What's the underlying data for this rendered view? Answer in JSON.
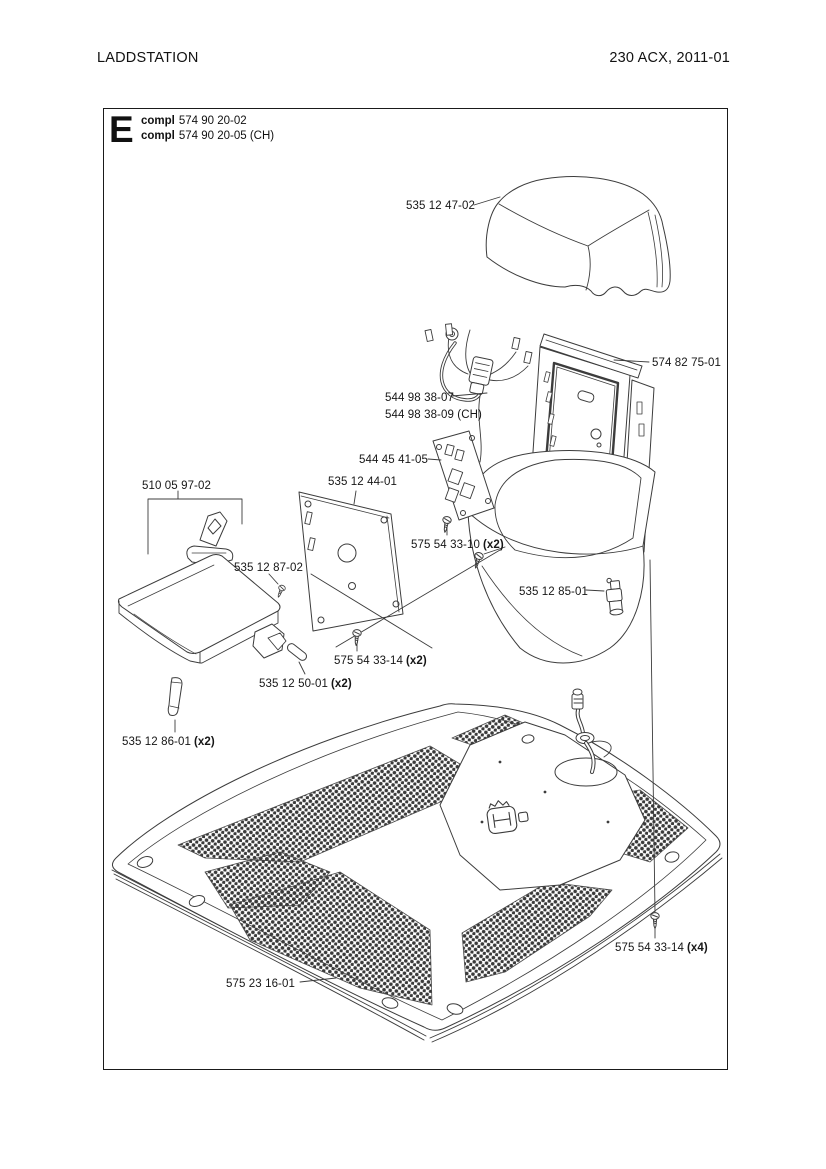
{
  "header": {
    "doc_title": "LADDSTATION",
    "model_revision": "230 ACX, 2011-01"
  },
  "diagram": {
    "section_letter": "E",
    "assemblies": [
      {
        "prefix": "compl",
        "number": "574 90 20-02"
      },
      {
        "prefix": "compl",
        "number": "574 90 20-05 (CH)"
      }
    ],
    "part_labels": [
      {
        "part": "top-cover",
        "text": "535 12 47-02",
        "qty": ""
      },
      {
        "part": "rear-frame",
        "text": "574 82 75-01",
        "qty": ""
      },
      {
        "part": "wiring-harness",
        "text": "544 98 38-07",
        "qty": ""
      },
      {
        "part": "wiring-harness-ch",
        "text": "544 98 38-09 (CH)",
        "qty": ""
      },
      {
        "part": "circuit-board",
        "text": "544 45 41-05",
        "qty": ""
      },
      {
        "part": "mounting-plate",
        "text": "535 12 44-01",
        "qty": ""
      },
      {
        "part": "hinge-kit",
        "text": "510 05 97-02",
        "qty": ""
      },
      {
        "part": "screw-33-10",
        "text": "575 54 33-10",
        "qty": "(x2)"
      },
      {
        "part": "screw-87-02",
        "text": "535 12 87-02",
        "qty": ""
      },
      {
        "part": "contact-bolt",
        "text": "535 12 85-01",
        "qty": ""
      },
      {
        "part": "screw-33-14-2",
        "text": "575 54 33-14",
        "qty": "(x2)"
      },
      {
        "part": "pin",
        "text": "535 12 50-01",
        "qty": "(x2)"
      },
      {
        "part": "clip",
        "text": "535 12 86-01",
        "qty": "(x2)"
      },
      {
        "part": "screw-33-14-4",
        "text": "575 54 33-14",
        "qty": "(x4)"
      },
      {
        "part": "base-plate",
        "text": "575 23 16-01",
        "qty": ""
      }
    ]
  },
  "colors": {
    "line": "#3c3c3c",
    "text": "#161616",
    "background": "#ffffff"
  }
}
